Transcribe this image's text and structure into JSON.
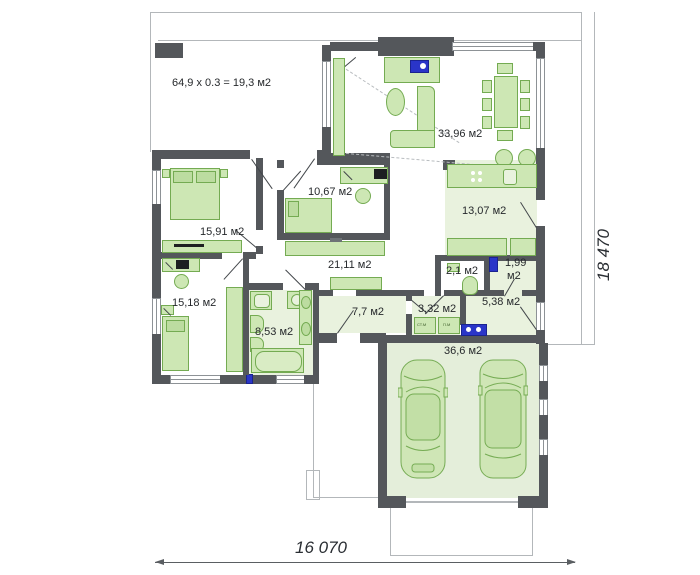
{
  "plan_title": "one-storey house floor plan",
  "terrace": {
    "note": "64,9 x 0.3 = 19,3 м2"
  },
  "rooms": {
    "living": "33,96 м2",
    "kitchen": "13,07 м2",
    "bedroom_small": "10,67 м2",
    "bedroom_main": "15,91 м2",
    "corridor": "21,11 м2",
    "wc": "2,1 м2",
    "pantry_line1": "1,99",
    "pantry_line2": "м2",
    "bedroom_left": "15,18 м2",
    "bathroom": "8,53 м2",
    "hall": "7,7 м2",
    "laundry": "3,32 м2",
    "entry": "5,38 м2",
    "garage": "36,6 м2"
  },
  "appliances": {
    "washer": "СТ.М",
    "dryer": "П.М"
  },
  "dimensions": {
    "width": "16 070",
    "depth": "18 470"
  },
  "colors": {
    "wall": "#54575b",
    "furniture_fill": "#cde7b4",
    "furniture_stroke": "#74ab52",
    "floor_tint": "#e9f2de",
    "accent_blue": "#2a35c8",
    "outline": "#b3b7ba"
  }
}
